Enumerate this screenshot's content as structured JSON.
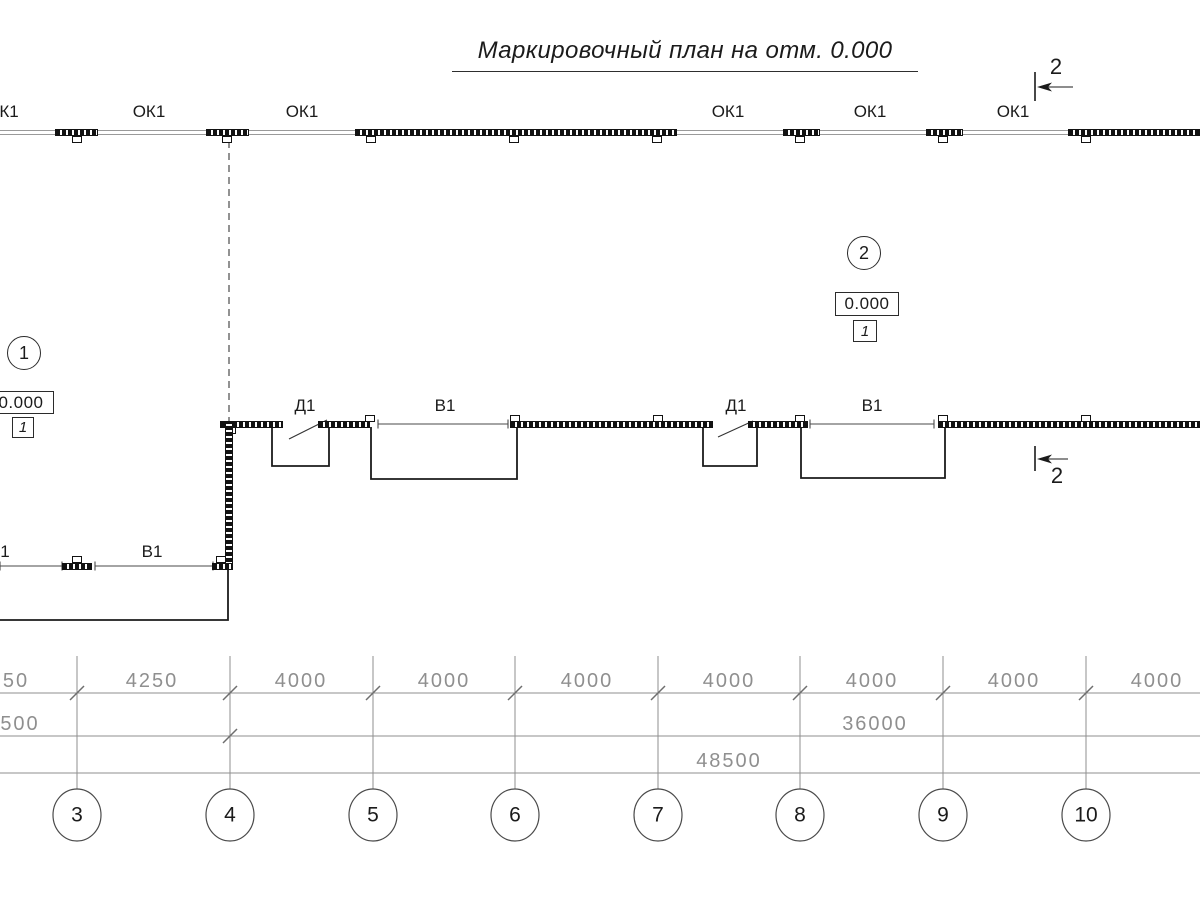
{
  "title": "Маркировочный план на отм. 0.000",
  "colors": {
    "ink": "#1b1b1b",
    "dim": "#8f8f8f",
    "wall_line": "#9a9a9a",
    "thin": "#4a4a4a"
  },
  "top_wall": {
    "y": 130,
    "label_y": 103,
    "windows": [
      {
        "x": 55,
        "w": 43,
        "tabs": [
          77
        ]
      },
      {
        "x": 206,
        "w": 43,
        "tabs": [
          227
        ]
      },
      {
        "x": 355,
        "w": 322,
        "tabs": [
          371,
          514,
          657
        ]
      },
      {
        "x": 783,
        "w": 37,
        "tabs": [
          800
        ]
      },
      {
        "x": 926,
        "w": 37,
        "tabs": [
          943
        ]
      },
      {
        "x": 1068,
        "w": 132,
        "tabs": [
          1086
        ]
      }
    ],
    "labels": [
      {
        "text": "К1",
        "cx": 9
      },
      {
        "text": "ОК1",
        "cx": 149
      },
      {
        "text": "ОК1",
        "cx": 302
      },
      {
        "text": "ОК1",
        "cx": 728
      },
      {
        "text": "ОК1",
        "cx": 870
      },
      {
        "text": "ОК1",
        "cx": 1013
      }
    ]
  },
  "section_marks": [
    {
      "label": "2",
      "tick_x": 1035,
      "tick_y1": 72,
      "tick_y2": 101,
      "arrow_y": 87,
      "arrow_x2": 1073,
      "label_cx": 1056,
      "label_y": 56
    },
    {
      "label": "2",
      "tick_x": 1035,
      "tick_y1": 446,
      "tick_y2": 471,
      "arrow_y": 459,
      "arrow_x2": 1068,
      "label_cx": 1057,
      "label_y": 465
    }
  ],
  "area_markers": [
    {
      "number": "1",
      "cx": 24,
      "cy": 353
    },
    {
      "number": "2",
      "cx": 864,
      "cy": 253
    }
  ],
  "elevation_marks": [
    {
      "value": "0.000",
      "ref": "1",
      "x": -12,
      "y": 391,
      "w": 66,
      "h": 23,
      "rx": 12,
      "ry": 417,
      "rw": 22,
      "rh": 21
    },
    {
      "value": "0.000",
      "ref": "1",
      "x": 835,
      "y": 292,
      "w": 64,
      "h": 24,
      "rx": 853,
      "ry": 320,
      "rw": 24,
      "rh": 22
    }
  ],
  "dashed_line": {
    "x": 229,
    "y1": 141,
    "y2": 421
  },
  "mid_wall": {
    "y": 421,
    "segments": [
      {
        "x": 220,
        "w": 63
      },
      {
        "x": 318,
        "w": 52
      },
      {
        "x": 510,
        "w": 203
      },
      {
        "x": 748,
        "w": 60
      },
      {
        "x": 938,
        "w": 262
      }
    ],
    "tabs_above": [
      370,
      515,
      658,
      800,
      943,
      1086
    ],
    "tabs_below": [
      231
    ],
    "door_labels": [
      {
        "text": "Д1",
        "cx": 305,
        "y": 397
      },
      {
        "text": "Д1",
        "cx": 736,
        "y": 397
      }
    ],
    "door_leaves": [
      {
        "x1": 289,
        "y1": 439,
        "x2": 327,
        "y2": 420
      },
      {
        "x1": 718,
        "y1": 437,
        "x2": 753,
        "y2": 421
      }
    ],
    "openings": [
      {
        "x1": 378,
        "x2": 508,
        "y": 424,
        "label": "В1",
        "cx": 445,
        "ly": 397
      },
      {
        "x1": 810,
        "x2": 934,
        "y": 424,
        "label": "В1",
        "cx": 872,
        "ly": 397
      }
    ],
    "recesses": [
      {
        "x1": 272,
        "x2": 329,
        "y1": 427,
        "y2": 466
      },
      {
        "x1": 371,
        "x2": 517,
        "y1": 427,
        "y2": 479
      },
      {
        "x1": 703,
        "x2": 757,
        "y1": 427,
        "y2": 466
      },
      {
        "x1": 801,
        "x2": 945,
        "y1": 427,
        "y2": 478
      }
    ]
  },
  "left_wall": {
    "x": 225,
    "y1": 421,
    "y2": 569
  },
  "bottom_wall": {
    "y": 563,
    "label_y": 543,
    "segments": [
      {
        "x": 62,
        "w": 30,
        "tab_cx": 77
      },
      {
        "x": 212,
        "w": 21,
        "tab_cx": 221
      }
    ],
    "openings": [
      {
        "x1": 0,
        "x2": 62,
        "y": 566
      },
      {
        "x1": 95,
        "x2": 213,
        "y": 566
      }
    ],
    "labels": [
      {
        "text": "1",
        "cx": 5
      },
      {
        "text": "В1",
        "cx": 152
      }
    ]
  },
  "outline": {
    "points": "228,569 228,620 0,620"
  },
  "dimensions": {
    "label_offset": 22,
    "ext_lines": {
      "xs": [
        77,
        230,
        373,
        515,
        658,
        800,
        943,
        1086
      ],
      "y1": 656,
      "y2": 789
    },
    "rows": [
      {
        "y": 693,
        "ticks": [
          77,
          230,
          373,
          515,
          658,
          800,
          943,
          1086
        ],
        "labels": [
          {
            "text": "50",
            "cx": 16
          },
          {
            "text": "4250",
            "cx": 152
          },
          {
            "text": "4000",
            "cx": 301
          },
          {
            "text": "4000",
            "cx": 444
          },
          {
            "text": "4000",
            "cx": 587
          },
          {
            "text": "4000",
            "cx": 729
          },
          {
            "text": "4000",
            "cx": 872
          },
          {
            "text": "4000",
            "cx": 1014
          },
          {
            "text": "4000",
            "cx": 1157
          }
        ]
      },
      {
        "y": 736,
        "ticks": [
          230
        ],
        "labels": [
          {
            "text": "500",
            "cx": 20
          },
          {
            "text": "36000",
            "cx": 875
          }
        ]
      },
      {
        "y": 773,
        "ticks": [],
        "labels": [
          {
            "text": "48500",
            "cx": 729
          }
        ]
      }
    ]
  },
  "grid_bubbles": {
    "cy": 815,
    "rx": 24,
    "ry": 26,
    "items": [
      {
        "label": "3",
        "x": 77
      },
      {
        "label": "4",
        "x": 230
      },
      {
        "label": "5",
        "x": 373
      },
      {
        "label": "6",
        "x": 515
      },
      {
        "label": "7",
        "x": 658
      },
      {
        "label": "8",
        "x": 800
      },
      {
        "label": "9",
        "x": 943
      },
      {
        "label": "10",
        "x": 1086
      }
    ]
  }
}
